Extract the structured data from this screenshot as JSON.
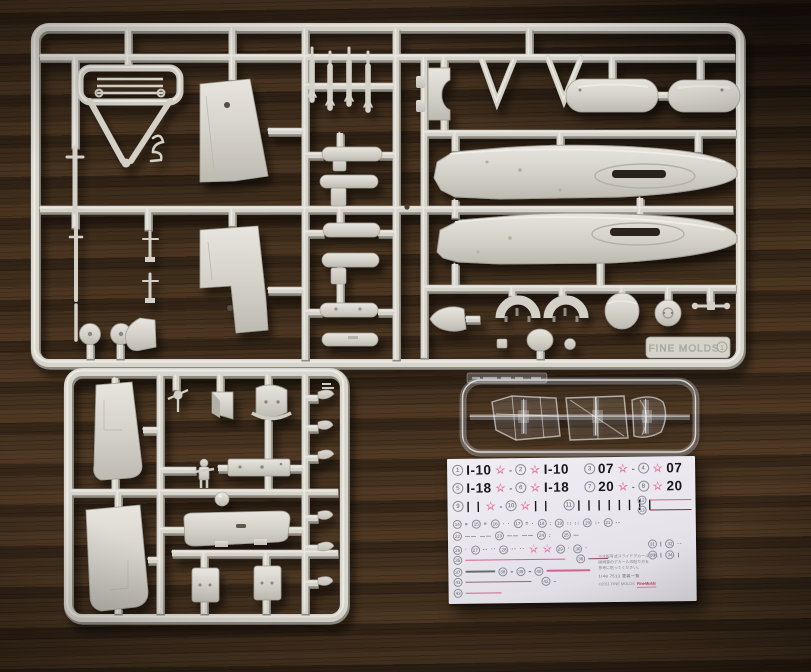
{
  "scene": {
    "description_colors": {
      "wood": "#3a2a1a",
      "plastic": "#d6d3cb",
      "plastic_shadow": "#8f8c84",
      "decal_paper": "#eae8ee",
      "ink_black": "#17171d",
      "star_pink": "#e07da6",
      "line_pink": "#d4638c",
      "line_dark_red": "#7b2f4a"
    }
  },
  "sprues": {
    "plate_text": "FINE MOLDS",
    "plate_badge": "1"
  },
  "decal": {
    "rows": [
      {
        "top": 4,
        "left": 5,
        "size": "lg",
        "items": [
          [
            "n",
            "1"
          ],
          [
            "t",
            "I-10"
          ],
          [
            "star"
          ],
          [
            "dash"
          ],
          [
            "n",
            "2"
          ],
          [
            "star"
          ],
          [
            "t",
            "I-10"
          ],
          [
            "gap",
            9
          ],
          [
            "n",
            "3"
          ],
          [
            "t",
            "07"
          ],
          [
            "star"
          ],
          [
            "dash"
          ],
          [
            "n",
            "4"
          ],
          [
            "star"
          ],
          [
            "t",
            "07"
          ]
        ]
      },
      {
        "top": 22,
        "left": 5,
        "size": "lg",
        "items": [
          [
            "n",
            "5"
          ],
          [
            "t",
            "I-18"
          ],
          [
            "star"
          ],
          [
            "dash"
          ],
          [
            "n",
            "6"
          ],
          [
            "star"
          ],
          [
            "t",
            "I-18"
          ],
          [
            "gap",
            9
          ],
          [
            "n",
            "7"
          ],
          [
            "t",
            "20"
          ],
          [
            "star"
          ],
          [
            "dash"
          ],
          [
            "n",
            "8"
          ],
          [
            "star"
          ],
          [
            "t",
            "20"
          ]
        ]
      },
      {
        "top": 41,
        "left": 5,
        "size": "lg",
        "items": [
          [
            "n",
            "9"
          ],
          [
            "bars",
            2
          ],
          [
            "star"
          ],
          [
            "dash"
          ],
          [
            "n",
            "10"
          ],
          [
            "star"
          ],
          [
            "bars",
            2
          ],
          [
            "gap",
            8
          ],
          [
            "n",
            "11"
          ],
          [
            "bars",
            8
          ]
        ]
      },
      {
        "top": 39,
        "left": 190,
        "size": "sm",
        "items": [
          [
            "n",
            "12"
          ],
          [
            "line",
            42,
            "#d4638c"
          ]
        ]
      },
      {
        "top": 49,
        "left": 190,
        "size": "sm",
        "items": [
          [
            "n",
            "13"
          ],
          [
            "line",
            42,
            "#7b2f4a"
          ]
        ]
      },
      {
        "top": 61,
        "left": 5,
        "size": "sm",
        "items": [
          [
            "n",
            "14"
          ],
          [
            "mark",
            "≡"
          ],
          [
            "n",
            "15"
          ],
          [
            "mark",
            "≡"
          ],
          [
            "n",
            "16"
          ],
          [
            "mark",
            "· ·"
          ],
          [
            "n",
            "17"
          ],
          [
            "mark",
            "= ·"
          ],
          [
            "n",
            "18"
          ],
          [
            "mark",
            ":"
          ],
          [
            "n",
            "19"
          ],
          [
            "mark",
            ":: ::"
          ],
          [
            "n",
            "20"
          ],
          [
            "mark",
            ":-"
          ],
          [
            "n",
            "21"
          ],
          [
            "mark",
            "--"
          ]
        ]
      },
      {
        "top": 73,
        "left": 5,
        "size": "sm",
        "items": [
          [
            "n",
            "22"
          ],
          [
            "mark",
            "——"
          ],
          [
            "mark",
            "——"
          ],
          [
            "n",
            "23"
          ],
          [
            "mark",
            "——"
          ],
          [
            "mark",
            "——"
          ],
          [
            "n",
            "24"
          ],
          [
            "mark",
            ":"
          ],
          [
            "gap",
            4
          ],
          [
            "n",
            "25"
          ],
          [
            "mark",
            "—"
          ]
        ]
      },
      {
        "top": 85,
        "left": 5,
        "size": "sm",
        "items": [
          [
            "n",
            "26"
          ],
          [
            "mark",
            "·"
          ],
          [
            "n",
            "27"
          ],
          [
            "mark",
            "--"
          ],
          [
            "mark",
            "··"
          ],
          [
            "n",
            "28"
          ],
          [
            "mark",
            "--"
          ],
          [
            "mark",
            "··"
          ],
          [
            "star"
          ],
          [
            "star"
          ],
          [
            "n",
            "29"
          ],
          [
            "mark",
            "·"
          ],
          [
            "n",
            "30"
          ],
          [
            "mark",
            "·"
          ]
        ]
      },
      {
        "top": 83,
        "left": 200,
        "size": "sm",
        "items": [
          [
            "n",
            "31"
          ],
          [
            "mark",
            "|"
          ],
          [
            "n",
            "32"
          ],
          [
            "mark",
            "··"
          ]
        ]
      },
      {
        "top": 94,
        "left": 200,
        "size": "sm",
        "items": [
          [
            "n",
            "33"
          ],
          [
            "mark",
            "|"
          ],
          [
            "n",
            "34"
          ],
          [
            "mark",
            "|"
          ]
        ]
      },
      {
        "top": 97,
        "left": 5,
        "size": "sm",
        "items": [
          [
            "n",
            "35"
          ],
          [
            "line",
            100,
            "#d4638c"
          ],
          [
            "gap",
            5
          ],
          [
            "n",
            "36"
          ],
          [
            "line",
            20,
            "#8a4a62"
          ]
        ]
      },
      {
        "top": 108,
        "left": 5,
        "size": "sm",
        "items": [
          [
            "n",
            "37"
          ],
          [
            "line",
            30,
            "#6a6a72"
          ],
          [
            "n",
            "38"
          ],
          [
            "dash"
          ],
          [
            "n",
            "39"
          ],
          [
            "dash"
          ],
          [
            "n",
            "40"
          ],
          [
            "line",
            44,
            "#d4638c"
          ]
        ]
      },
      {
        "top": 119,
        "left": 5,
        "size": "sm",
        "items": [
          [
            "n",
            "41"
          ],
          [
            "line",
            66,
            "#8a6a74"
          ],
          [
            "gap",
            4
          ],
          [
            "n",
            "42"
          ],
          [
            "mark",
            "–"
          ]
        ]
      },
      {
        "top": 130,
        "left": 5,
        "size": "sm",
        "items": [
          [
            "n",
            "43"
          ],
          [
            "line",
            36,
            "#d4638c"
          ]
        ]
      }
    ],
    "note": {
      "line1": "※水転写式スライドデカールです。",
      "line2": "説明書のデカールの貼り方を",
      "line3": "参考に貼ってください。",
      "footer": "1/48 7513 塗装一覧",
      "copyright": "©2011 FINE MOLDS",
      "logo": "FineMolds"
    }
  }
}
